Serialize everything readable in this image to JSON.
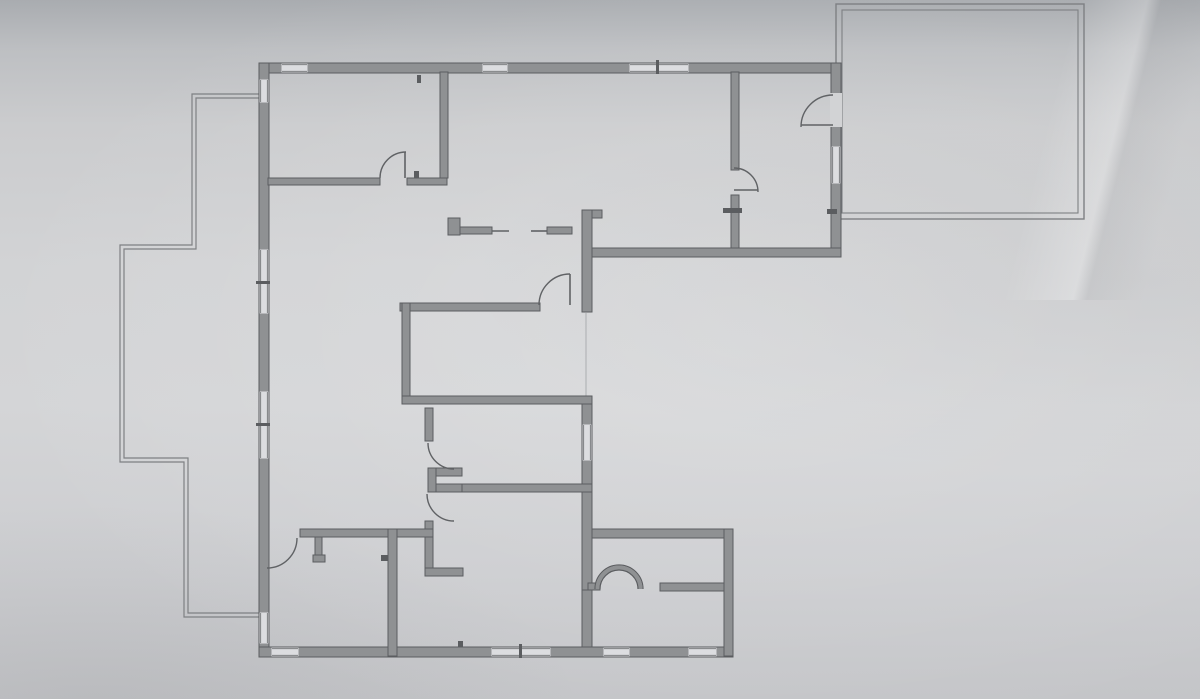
{
  "scene": {
    "kind": "floor-plan-photo",
    "canvas": {
      "width": 1200,
      "height": 699
    },
    "colors": {
      "paper": "#d2d3d5",
      "window_white": "#dcdde0",
      "wall_fill": "#8f9193",
      "wall_edge": "#5b5d60",
      "thin_line": "#7e8083",
      "arc_line": "#606265",
      "faint_line": "#abadb0"
    }
  },
  "floor_plan": {
    "walls": [
      [
        260,
        63,
        578,
        10
      ],
      [
        259,
        63,
        10,
        594
      ],
      [
        259,
        647,
        474,
        10
      ],
      [
        831,
        63,
        10,
        194
      ],
      [
        582,
        248,
        259,
        9
      ],
      [
        582,
        210,
        10,
        102
      ],
      [
        592,
        210,
        10,
        8
      ],
      [
        582,
        396,
        10,
        194
      ],
      [
        582,
        590,
        10,
        57
      ],
      [
        588,
        583,
        12,
        7
      ],
      [
        592,
        529,
        141,
        9
      ],
      [
        724,
        529,
        9,
        127
      ],
      [
        660,
        583,
        64,
        8
      ],
      [
        268,
        178,
        112,
        7
      ],
      [
        407,
        178,
        40,
        7
      ],
      [
        440,
        72,
        8,
        106
      ],
      [
        731,
        72,
        8,
        98
      ],
      [
        731,
        195,
        8,
        53
      ],
      [
        400,
        303,
        140,
        8
      ],
      [
        402,
        303,
        8,
        95
      ],
      [
        402,
        396,
        190,
        8
      ],
      [
        425,
        408,
        8,
        33
      ],
      [
        428,
        468,
        34,
        8
      ],
      [
        428,
        484,
        34,
        8
      ],
      [
        428,
        468,
        8,
        24
      ],
      [
        425,
        521,
        8,
        10
      ],
      [
        425,
        537,
        8,
        33
      ],
      [
        425,
        568,
        38,
        8
      ],
      [
        300,
        529,
        88,
        8
      ],
      [
        397,
        529,
        36,
        8
      ],
      [
        388,
        529,
        9,
        127
      ],
      [
        315,
        537,
        7,
        23
      ],
      [
        313,
        555,
        12,
        7
      ],
      [
        462,
        484,
        130,
        8
      ]
    ],
    "door_gaps": [
      [
        830,
        93,
        12,
        34
      ]
    ],
    "counters": [
      [
        448,
        218,
        12,
        17
      ],
      [
        460,
        227,
        32,
        7
      ],
      [
        547,
        227,
        25,
        7
      ]
    ],
    "counter_lines": [
      [
        492,
        231,
        509,
        231
      ],
      [
        531,
        231,
        547,
        231
      ]
    ],
    "windows": [
      {
        "rect": [
          282,
          64,
          25,
          8
        ],
        "orient": "h"
      },
      {
        "rect": [
          483,
          64,
          24,
          8
        ],
        "orient": "h"
      },
      {
        "rect": [
          630,
          64,
          58,
          8
        ],
        "orient": "h",
        "tick": [
          656,
          60,
          3,
          14
        ]
      },
      {
        "rect": [
          272,
          648,
          26,
          8
        ],
        "orient": "h"
      },
      {
        "rect": [
          492,
          648,
          58,
          8
        ],
        "orient": "h",
        "tick": [
          519,
          644,
          3,
          14
        ]
      },
      {
        "rect": [
          604,
          648,
          25,
          8
        ],
        "orient": "h"
      },
      {
        "rect": [
          689,
          648,
          27,
          8
        ],
        "orient": "h"
      },
      {
        "rect": [
          260,
          80,
          8,
          22
        ],
        "orient": "v"
      },
      {
        "rect": [
          260,
          250,
          8,
          63
        ],
        "orient": "v",
        "tick": [
          256,
          281,
          14,
          3
        ]
      },
      {
        "rect": [
          260,
          392,
          8,
          66
        ],
        "orient": "v",
        "tick": [
          256,
          423,
          14,
          3
        ]
      },
      {
        "rect": [
          260,
          613,
          8,
          30
        ],
        "orient": "v"
      },
      {
        "rect": [
          832,
          147,
          8,
          36
        ],
        "orient": "v"
      },
      {
        "rect": [
          583,
          425,
          8,
          35
        ],
        "orient": "v"
      }
    ],
    "doors": [
      {
        "p0": [
          380,
          178
        ],
        "p1": [
          406,
          152
        ],
        "r": 26,
        "sweep": 1,
        "leaf": [
          405,
          152,
          405,
          178
        ]
      },
      {
        "p0": [
          833,
          95
        ],
        "p1": [
          801,
          127
        ],
        "r": 32,
        "sweep": 0,
        "leaf": [
          801,
          125,
          833,
          125
        ]
      },
      {
        "p0": [
          734,
          168
        ],
        "p1": [
          758,
          192
        ],
        "r": 24,
        "sweep": 1,
        "leaf": [
          734,
          190,
          758,
          190
        ]
      },
      {
        "p0": [
          539,
          305
        ],
        "p1": [
          570,
          274
        ],
        "r": 31,
        "sweep": 1,
        "leaf": [
          570,
          274,
          570,
          305
        ]
      },
      {
        "p0": [
          428,
          443
        ],
        "p1": [
          454,
          469
        ],
        "r": 26,
        "sweep": 0
      },
      {
        "p0": [
          427,
          494
        ],
        "p1": [
          454,
          521
        ],
        "r": 27,
        "sweep": 0
      },
      {
        "p0": [
          297,
          538
        ],
        "p1": [
          267,
          568
        ],
        "r": 30,
        "sweep": 1
      }
    ],
    "arch": {
      "cx": 619,
      "cy": 589,
      "r_outer": 24,
      "r_inner": 19
    },
    "ticks": [
      [
        417,
        75,
        4,
        8
      ],
      [
        414,
        171,
        5,
        7
      ],
      [
        723,
        208,
        19,
        5
      ],
      [
        827,
        209,
        10,
        5
      ],
      [
        381,
        555,
        7,
        6
      ],
      [
        458,
        641,
        5,
        6
      ]
    ],
    "patio_paths": [
      [
        [
          259,
          94
        ],
        [
          192,
          94
        ],
        [
          192,
          245
        ],
        [
          120,
          245
        ],
        [
          120,
          462
        ],
        [
          184,
          462
        ],
        [
          184,
          617
        ],
        [
          259,
          617
        ]
      ],
      [
        [
          259,
          98
        ],
        [
          196,
          98
        ],
        [
          196,
          249
        ],
        [
          124,
          249
        ],
        [
          124,
          458
        ],
        [
          188,
          458
        ],
        [
          188,
          613
        ],
        [
          259,
          613
        ]
      ]
    ],
    "slider_line": [
      586,
      313,
      586,
      397
    ],
    "garage": {
      "outer": [
        836,
        4,
        248,
        215
      ],
      "inner": [
        842,
        10,
        236,
        203
      ]
    }
  }
}
